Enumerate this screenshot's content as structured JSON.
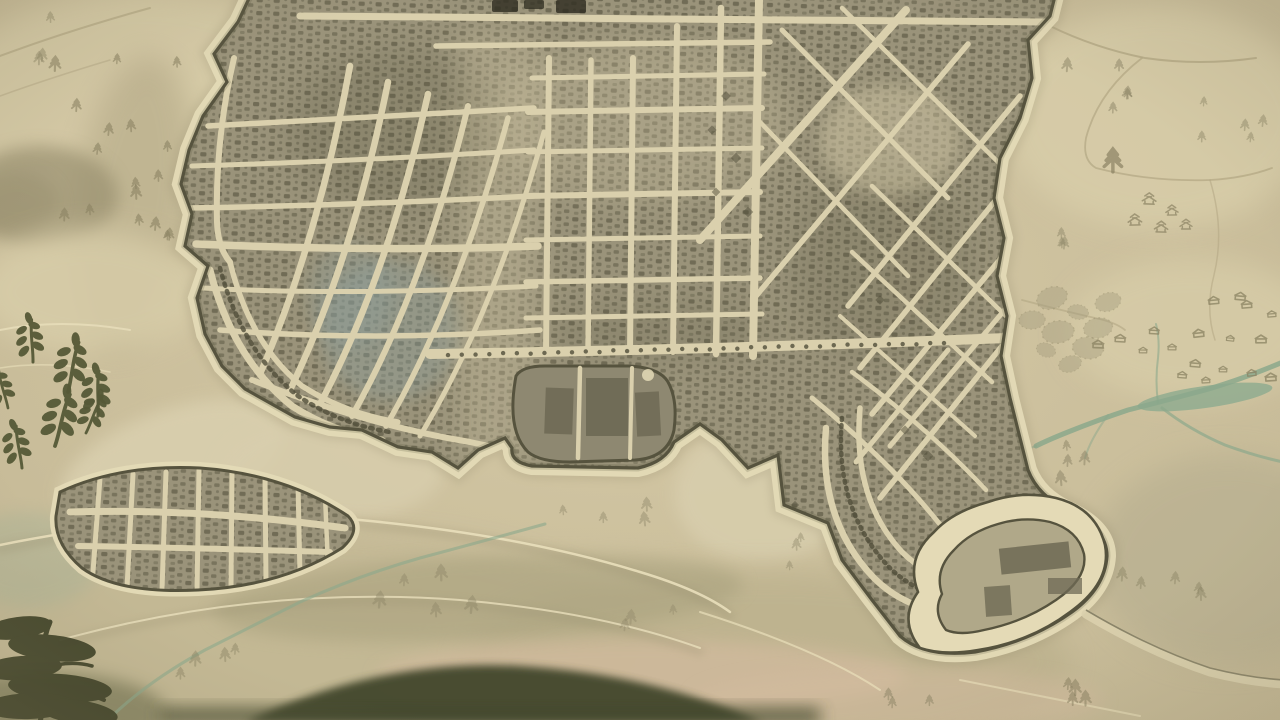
{
  "meta": {
    "title": "Hand-drawn antique city map",
    "alt": "Aged parchment map of a walled coastal city with hatched building blocks, ring roads, a suburb district, surrounding hills, pine trees, rivers and dark foreground plants"
  },
  "palette": {
    "paper_center": "#d5c9a6",
    "paper_edge": "#c2b693",
    "street": "#dad0ad",
    "block": "#9a937a",
    "hatch": "#504d39",
    "wall": "#56533e",
    "shore": "#e4dab6",
    "shore_smudge": "#8f8669",
    "ink": "#2e2c20",
    "water": "#8ba88c",
    "pool": "#93ad90",
    "wash_teal": "#8b9f9e",
    "corridor": "#d9cfae",
    "bay": "#d8cead",
    "plaza": "#d6cba8",
    "enclave": "#8e8871",
    "enclave_bldg": "#6f6a55",
    "harbor_inner": "#b0a889",
    "tree_faint": "#8a8263",
    "house": "#8a8162",
    "sprig": "#565937",
    "fg_tree": "#3d4026",
    "hill_light": "#d8cda9",
    "hill_shadow": "#a89d7c",
    "hill_dark": "#99906f",
    "south_hill": "#c3b894",
    "south_hill2": "#bcb18d",
    "olive_band": "#a7a07d",
    "pink": "#d3bb9f",
    "south_dark": "#45482e",
    "marsh": "#a9b295",
    "bl_dark": "#696a49",
    "ridge": "#e9dfbb",
    "ridge_shadow": "#968d6e",
    "trail": "#b2a683",
    "se_green": "#b7af90",
    "yellow_patch": "#d9c88e",
    "grove": "#a29a7c"
  },
  "features": {
    "seed": 7,
    "city": {
      "label": "walled city with hatched blocks"
    },
    "tree_clusters": [
      {
        "x": 128,
        "y": 148,
        "n": 13,
        "sx": 75,
        "sy": 88,
        "s": 1.05,
        "o": 0.6
      },
      {
        "x": 158,
        "y": 218,
        "n": 4,
        "sx": 30,
        "sy": 26,
        "s": 1.0,
        "o": 0.6
      },
      {
        "x": 34,
        "y": 44,
        "n": 3,
        "sx": 26,
        "sy": 22,
        "s": 0.9,
        "o": 0.45
      },
      {
        "x": 1108,
        "y": 96,
        "n": 5,
        "sx": 42,
        "sy": 26,
        "s": 0.95,
        "o": 0.5
      },
      {
        "x": 1232,
        "y": 112,
        "n": 5,
        "sx": 42,
        "sy": 30,
        "s": 0.9,
        "o": 0.45
      },
      {
        "x": 1112,
        "y": 170,
        "n": 1,
        "sx": 4,
        "sy": 4,
        "s": 1.7,
        "o": 0.7
      },
      {
        "x": 1078,
        "y": 246,
        "n": 3,
        "sx": 26,
        "sy": 16,
        "s": 0.9,
        "o": 0.45
      },
      {
        "x": 1096,
        "y": 470,
        "n": 4,
        "sx": 44,
        "sy": 20,
        "s": 1.0,
        "o": 0.5
      },
      {
        "x": 1168,
        "y": 598,
        "n": 5,
        "sx": 55,
        "sy": 35,
        "s": 1.0,
        "o": 0.45
      },
      {
        "x": 1080,
        "y": 688,
        "n": 4,
        "sx": 38,
        "sy": 18,
        "s": 1.1,
        "o": 0.55
      },
      {
        "x": 424,
        "y": 598,
        "n": 5,
        "sx": 55,
        "sy": 26,
        "s": 1.25,
        "o": 0.4
      },
      {
        "x": 205,
        "y": 655,
        "n": 4,
        "sx": 45,
        "sy": 25,
        "s": 1.1,
        "o": 0.45
      },
      {
        "x": 628,
        "y": 628,
        "n": 3,
        "sx": 50,
        "sy": 20,
        "s": 1.0,
        "o": 0.35
      },
      {
        "x": 600,
        "y": 502,
        "n": 4,
        "sx": 55,
        "sy": 25,
        "s": 1.0,
        "o": 0.4
      },
      {
        "x": 772,
        "y": 560,
        "n": 3,
        "sx": 30,
        "sy": 22,
        "s": 0.95,
        "o": 0.4
      },
      {
        "x": 912,
        "y": 700,
        "n": 3,
        "sx": 30,
        "sy": 14,
        "s": 1.0,
        "o": 0.5
      }
    ],
    "houses": [
      [
        1214,
        304
      ],
      [
        1247,
        308
      ],
      [
        1272,
        317
      ],
      [
        1199,
        337
      ],
      [
        1230,
        341
      ],
      [
        1261,
        343
      ],
      [
        1154,
        334
      ],
      [
        1172,
        350
      ],
      [
        1143,
        353
      ],
      [
        1195,
        367
      ],
      [
        1223,
        372
      ],
      [
        1252,
        376
      ],
      [
        1271,
        381
      ],
      [
        1206,
        383
      ],
      [
        1182,
        378
      ],
      [
        1240,
        300
      ],
      [
        1120,
        342
      ],
      [
        1098,
        348
      ]
    ],
    "temples": [
      [
        1149,
        204
      ],
      [
        1172,
        215
      ],
      [
        1135,
        225
      ],
      [
        1186,
        229
      ],
      [
        1161,
        232
      ]
    ],
    "grove": [
      [
        1052,
        298
      ],
      [
        1078,
        312
      ],
      [
        1058,
        332
      ],
      [
        1088,
        348
      ],
      [
        1070,
        364
      ],
      [
        1046,
        350
      ],
      [
        1098,
        328
      ],
      [
        1108,
        302
      ],
      [
        1032,
        320
      ]
    ],
    "sprigs": [
      [
        33,
        362,
        1.5,
        -8
      ],
      [
        68,
        392,
        1.8,
        6
      ],
      [
        98,
        416,
        1.6,
        -5
      ],
      [
        55,
        446,
        1.9,
        10
      ],
      [
        22,
        468,
        1.5,
        -14
      ],
      [
        86,
        433,
        1.4,
        18
      ],
      [
        8,
        408,
        1.35,
        -20
      ]
    ],
    "diamond_marks": [
      [
        712,
        130
      ],
      [
        736,
        158
      ],
      [
        716,
        192
      ],
      [
        748,
        212
      ],
      [
        726,
        96
      ],
      [
        880,
        300
      ],
      [
        905,
        430
      ],
      [
        928,
        456
      ],
      [
        795,
        505
      ]
    ],
    "boulevard_dots": {
      "x0": 448,
      "y0": 355,
      "x1": 944,
      "y1": 343,
      "step": 13.5,
      "r": 2.2
    }
  }
}
